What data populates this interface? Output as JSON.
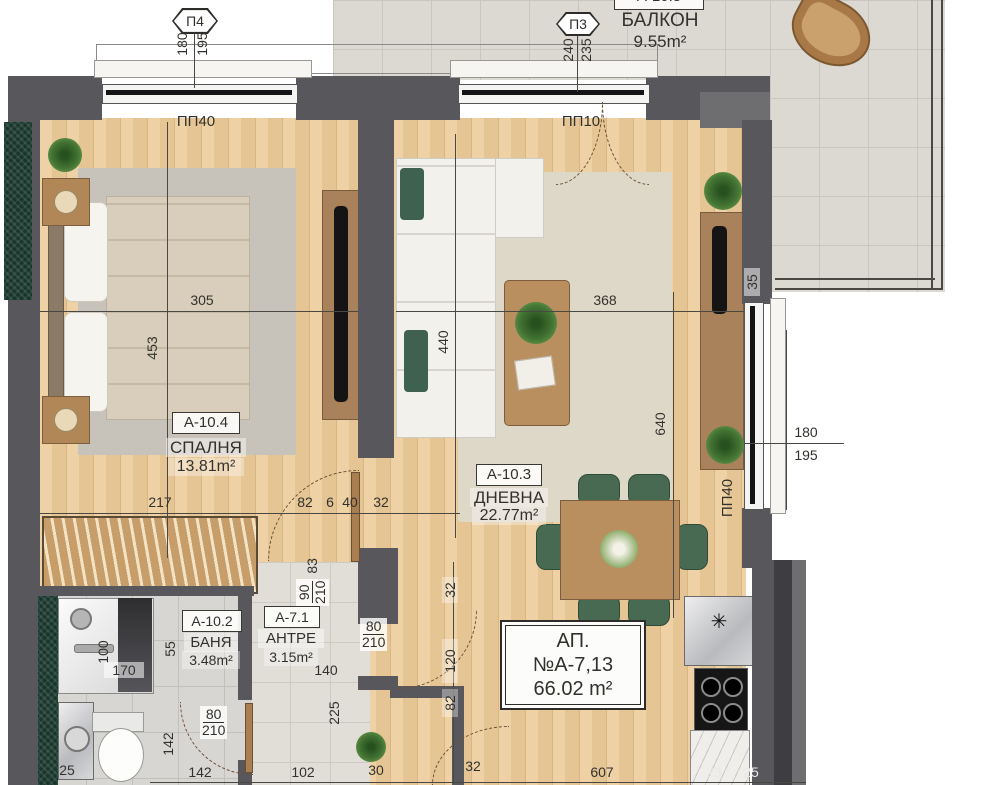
{
  "rooms": {
    "balcony": {
      "id": "А-10.5",
      "name": "БАЛКОН",
      "area": "9.55m²"
    },
    "bedroom": {
      "id": "А-10.4",
      "name": "СПАЛНЯ",
      "area": "13.81m²"
    },
    "living": {
      "id": "А-10.3",
      "name": "ДНЕВНА",
      "area": "22.77m²"
    },
    "bath": {
      "id": "А-10.2",
      "name": "БАНЯ",
      "area": "3.48m²"
    },
    "hall": {
      "id": "А-7.1",
      "name": "АНТРЕ",
      "area": "3.15m²"
    }
  },
  "apartment": {
    "title": "АП. №А-7,13",
    "area": "66.02 m²"
  },
  "markers": {
    "p4": {
      "id": "П4",
      "dim_a": "180",
      "dim_b": "195"
    },
    "p3": {
      "id": "П3",
      "dim_a": "240",
      "dim_b": "235"
    }
  },
  "windows": {
    "bedroom_top": "ПП40",
    "living_top": "ПП10",
    "living_side": "ПП40"
  },
  "dims": {
    "bedroom_width": "305",
    "bedroom_height": "453",
    "wardrobe": "217",
    "living_width": "368",
    "living_height_left": "440",
    "living_height_right": "640",
    "pier_35": "35",
    "right_win_a": "180",
    "right_win_b": "195",
    "chain_82": "82",
    "chain_6": "6",
    "chain_40": "40",
    "chain_32": "32",
    "bed_door_w": "90",
    "bed_door_h": "210",
    "jamb_83": "83",
    "shower_w": "100",
    "shower_l": "170",
    "gap_55": "55",
    "bath_142": "142",
    "bath_door_w": "80",
    "bath_door_h": "210",
    "hall_door_w": "80",
    "hall_door_h": "210",
    "hall_140": "140",
    "hall_225": "225",
    "kchain_32": "32",
    "kchain_120": "120",
    "kchain_82": "82",
    "bottom_25a": "25",
    "bottom_142": "142",
    "bottom_102": "102",
    "bottom_30": "30",
    "bottom_32": "32",
    "bottom_607": "607",
    "bottom_23": "23",
    "bottom_25b": "25"
  },
  "kitchen": {
    "sink_mark": "✳"
  },
  "colors": {
    "wall": "#58585c",
    "wood_floor": "#e7c795",
    "insulation_green": "#17352a",
    "chair_green": "#486a52",
    "balcony_tile": "#dcd9d2"
  }
}
